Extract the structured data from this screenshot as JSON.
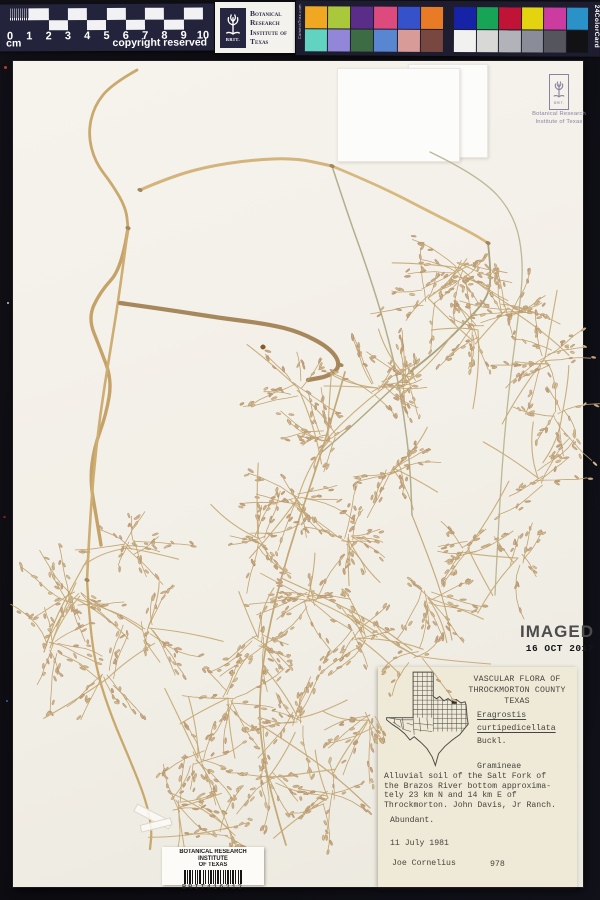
{
  "ruler_card": {
    "numbers": [
      "0",
      "1",
      "2",
      "3",
      "4",
      "5",
      "6",
      "7",
      "8",
      "9",
      "10"
    ],
    "unit_label": "cm",
    "copyright_label": "copyright reserved"
  },
  "brit_card": {
    "logo_text": "BRIT.",
    "org_lines": [
      "Botanical",
      "Research",
      "Institute of",
      "Texas"
    ]
  },
  "color_card": {
    "left_vertical_label": "CameraTrax.com",
    "right_vertical_label": "24ColorCard",
    "panel_left_top": [
      "#f0a722",
      "#a9c83b",
      "#5a2d89",
      "#dd4a7d",
      "#3652cb",
      "#e97b26"
    ],
    "panel_left_bottom": [
      "#62d2c1",
      "#9186d7",
      "#3d6b43",
      "#5886d1",
      "#d99b97",
      "#784840"
    ],
    "panel_right_top": [
      "#1623a7",
      "#18a456",
      "#c11336",
      "#e4d410",
      "#cb3ba0",
      "#2b92c7"
    ],
    "panel_right_bottom": [
      "#f1f1ef",
      "#d8d9d7",
      "#b2b3b9",
      "#8a8c98",
      "#54555d",
      "#121215"
    ]
  },
  "brit_stamp": {
    "line1": "Botanical Research",
    "line2": "Institute of Texas"
  },
  "imaged_stamp": {
    "text": "IMAGED",
    "date": "16 OCT 2017"
  },
  "label": {
    "heading_lines": [
      "VASCULAR FLORA OF",
      "THROCKMORTON COUNTY",
      "TEXAS"
    ],
    "genus": "Eragrostis",
    "species": "curtipedicellata",
    "author": "Buckl.",
    "family": "Gramineae",
    "locality_lines": [
      "Alluvial soil of the Salt Fork of",
      "the Brazos River bottom approxima-",
      "tely 23 km N and 14 km E of",
      "Throckmorton. John Davis, Jr Ranch."
    ],
    "abundance": "Abundant.",
    "collection_date": "11 July 1981",
    "collector": "Joe Cornelius",
    "collection_number": "978"
  },
  "barcode_label": {
    "org_line1": "BOTANICAL RESEARCH INSTITUTE",
    "org_line2": "OF TEXAS",
    "code": "BRIT416212"
  }
}
